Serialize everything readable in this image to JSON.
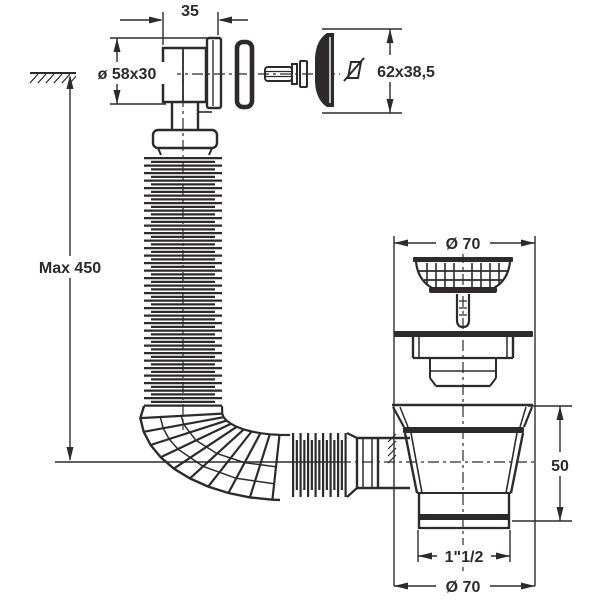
{
  "drawing": {
    "type": "technical-drawing",
    "subject": "sink-drain-with-overflow-and-flexible-hose",
    "background": "#ffffff",
    "line_color": "#2e2a2b",
    "dimensions": {
      "elbow_width": "35",
      "overflow_elbow": "ø 58x30",
      "overflow_cap": "62x38,5",
      "hose_max_length": "Max 450",
      "strainer_diameter": "Ø 70",
      "body_height": "50",
      "outlet_thread": "1\"1/2",
      "flange_diameter": "Ø 70"
    }
  }
}
